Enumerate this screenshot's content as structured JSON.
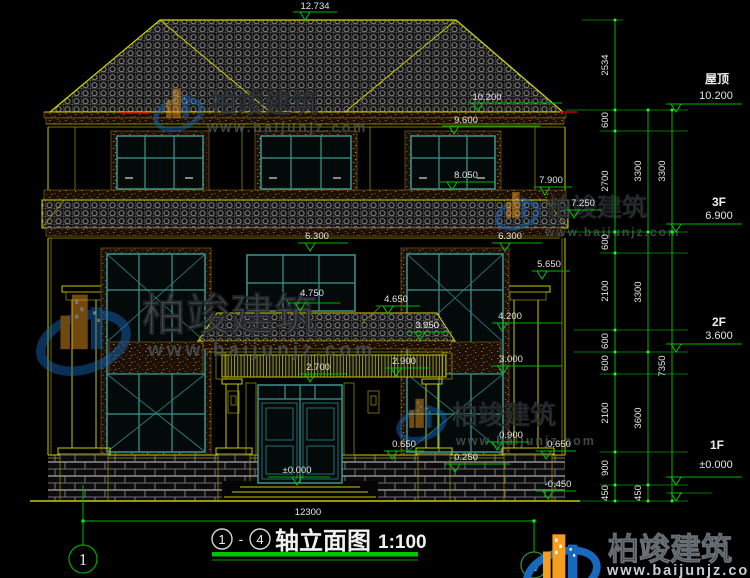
{
  "drawing": {
    "top_marker": "12.734",
    "overall_width_dim": "12300",
    "title": {
      "axis_start": "1",
      "axis_end": "4",
      "separator": "-",
      "name": "轴立面图",
      "scale": "1:100"
    },
    "right_levels": [
      {
        "name": "屋顶",
        "value": "10.200"
      },
      {
        "name": "3F",
        "value": "6.900"
      },
      {
        "name": "2F",
        "value": "3.600"
      },
      {
        "name": "1F",
        "value": "±0.000"
      }
    ],
    "chains": {
      "inner": [
        "2534",
        "600",
        "2700",
        "600",
        "2100",
        "600",
        "600",
        "2100",
        "900",
        "450"
      ],
      "middle": [
        "3300",
        "3300",
        "3600",
        "450"
      ],
      "outer": [
        "3300",
        "7350"
      ]
    },
    "markers": {
      "m12734": "12.734",
      "m10200": "10.200",
      "m9600": "9.600",
      "m8050": "8.050",
      "m7900": "7.900",
      "m7250": "7.250",
      "m6300l": "6.300",
      "m6300r": "6.300",
      "m5650": "5.650",
      "m4750": "4.750",
      "m4650": "4.650",
      "m4200": "4.200",
      "m3950": "3.950",
      "m3000": "3.000",
      "m2900": "2.900",
      "m2700": "2.700",
      "m0900": "0.900",
      "m0650l": "0.650",
      "m0650r": "0.650",
      "m0250": "0.250",
      "m0000": "±0.000",
      "mneg0450": "-0.450"
    },
    "axis_bubbles": [
      "1",
      "4"
    ]
  },
  "watermark": {
    "brand": "柏竣建筑",
    "url": "www.baijunjz.com"
  },
  "colors": {
    "background": "#000000",
    "dimension_green": "#00b400",
    "line_yellow": "#c8c800",
    "frame_teal": "#3d9691",
    "text_white": "#e4e4e4",
    "brand_blue": "#1769bd",
    "brand_orange": "#f59d1e"
  }
}
